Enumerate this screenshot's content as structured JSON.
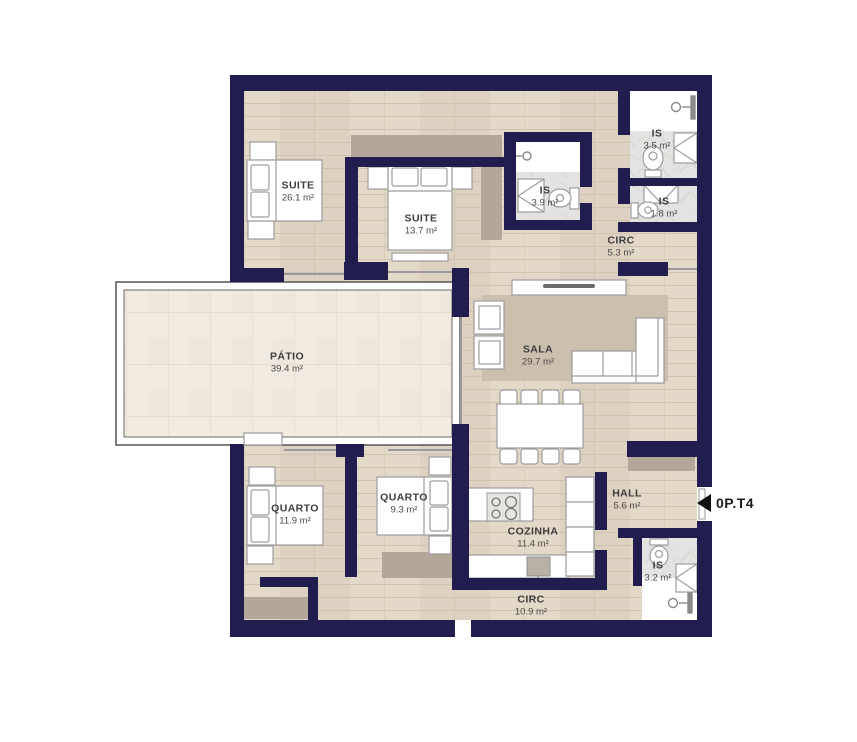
{
  "floorplan": {
    "unit_label": "0P.T4",
    "rooms": [
      {
        "id": "suite-1",
        "name": "SUITE",
        "area": "26.1 m²"
      },
      {
        "id": "suite-2",
        "name": "SUITE",
        "area": "13.7 m²"
      },
      {
        "id": "is-1",
        "name": "IS",
        "area": "3.9 m²"
      },
      {
        "id": "is-2",
        "name": "IS",
        "area": "3.5 m²"
      },
      {
        "id": "is-3",
        "name": "IS",
        "area": "1.8 m²"
      },
      {
        "id": "circ-1",
        "name": "CIRC",
        "area": "5.3 m²"
      },
      {
        "id": "patio",
        "name": "PÁTIO",
        "area": "39.4 m²"
      },
      {
        "id": "sala",
        "name": "SALA",
        "area": "29.7 m²"
      },
      {
        "id": "quarto-1",
        "name": "QUARTO",
        "area": "11.9 m²"
      },
      {
        "id": "quarto-2",
        "name": "QUARTO",
        "area": "9.3 m²"
      },
      {
        "id": "cozinha",
        "name": "COZINHA",
        "area": "11.4 m²"
      },
      {
        "id": "hall",
        "name": "HALL",
        "area": "5.6 m²"
      },
      {
        "id": "is-4",
        "name": "IS",
        "area": "3.2 m²"
      },
      {
        "id": "circ-2",
        "name": "CIRC",
        "area": "10.9 m²"
      }
    ],
    "colors": {
      "wall": "#221d4f",
      "wood_floor": "#ddd2c1",
      "patio_tile": "#f1ebe2",
      "marble": "#e4e3e1",
      "wardrobe": "#b3a799",
      "rug": "#cbbfae",
      "furniture_outline": "#9d9d9d"
    }
  }
}
